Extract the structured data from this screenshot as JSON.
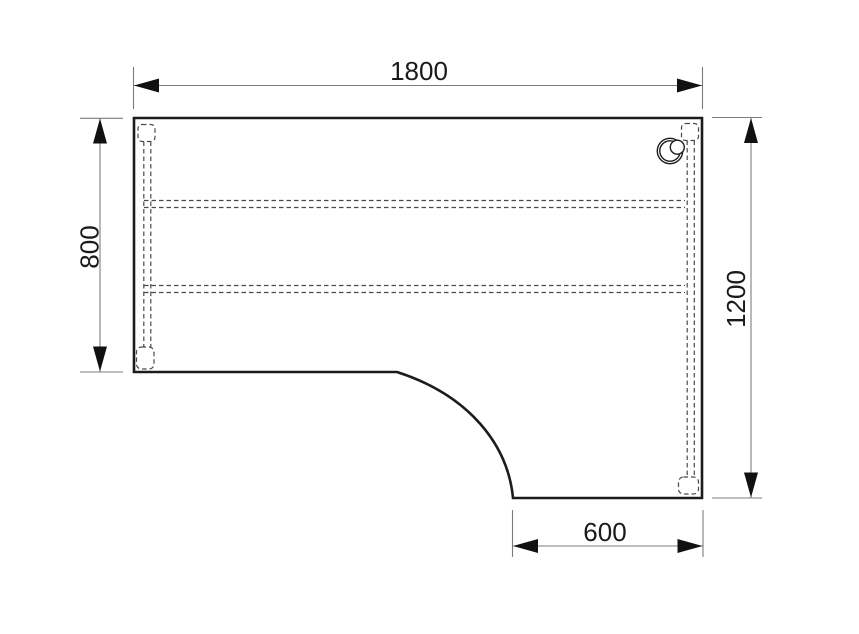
{
  "drawing": {
    "type": "technical-drawing-top-view",
    "subject": "l-shaped-corner-desk",
    "dimension_labels": {
      "top_width": "1800",
      "left_depth": "800",
      "right_depth": "1200",
      "return_width": "600"
    },
    "colors": {
      "background": "#ffffff",
      "outline": "#1c1c1c",
      "hidden_dashed_lines": "#4a4a4a",
      "dimension_lines": "#7d7d7d",
      "arrows_and_text": "#111111"
    }
  }
}
